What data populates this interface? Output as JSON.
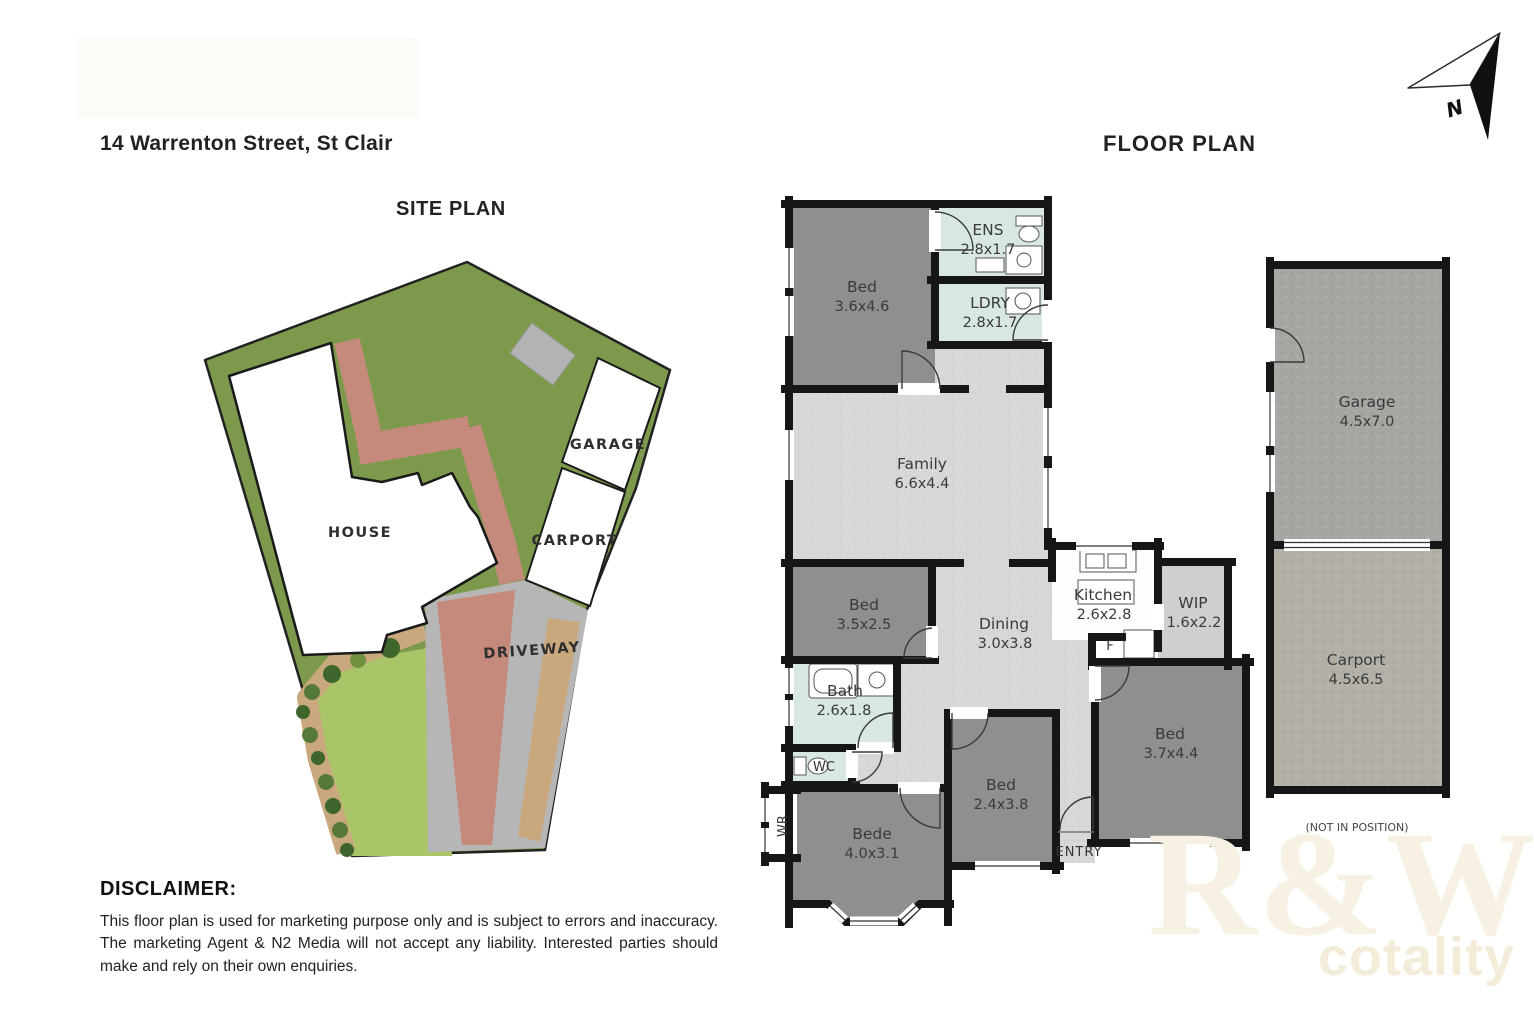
{
  "header": {
    "address": "14 Warrenton Street, St Clair",
    "site_plan_title": "SITE PLAN",
    "floor_plan_title": "FLOOR PLAN",
    "north_label": "N"
  },
  "site_plan": {
    "house_label": "HOUSE",
    "garage_label": "GARAGE",
    "carport_label": "CARPORT",
    "driveway_label": "DRIVEWAY"
  },
  "floor_plan": {
    "rooms": {
      "bed1": {
        "name": "Bed",
        "dims": "3.6x4.6"
      },
      "ens": {
        "name": "ENS",
        "dims": "2.8x1.7"
      },
      "ldry": {
        "name": "LDRY",
        "dims": "2.8x1.7"
      },
      "family": {
        "name": "Family",
        "dims": "6.6x4.4"
      },
      "bed2": {
        "name": "Bed",
        "dims": "3.5x2.5"
      },
      "kitchen": {
        "name": "Kitchen",
        "dims": "2.6x2.8"
      },
      "wip": {
        "name": "WIP",
        "dims": "1.6x2.2"
      },
      "dining": {
        "name": "Dining",
        "dims": "3.0x3.8"
      },
      "bath": {
        "name": "Bath",
        "dims": "2.6x1.8"
      },
      "wc": {
        "name": "WC"
      },
      "bede": {
        "name": "Bede",
        "dims": "4.0x3.1"
      },
      "bed3": {
        "name": "Bed",
        "dims": "2.4x3.8"
      },
      "bed4": {
        "name": "Bed",
        "dims": "3.7x4.4"
      },
      "garage": {
        "name": "Garage",
        "dims": "4.5x7.0"
      },
      "carport": {
        "name": "Carport",
        "dims": "4.5x6.5"
      }
    },
    "labels": {
      "fridge": "F",
      "wardrobe": "WR",
      "entry": "ENTRY",
      "not_in_position": "(NOT IN POSITION)"
    }
  },
  "disclaimer": {
    "title": "DISCLAIMER:",
    "body": "This floor plan is used for marketing purpose only and is subject to errors and inaccuracy. The marketing Agent & N2 Media will not accept any liability. Interested parties should make and rely on their own enquiries."
  },
  "watermark": {
    "brand": "R&W",
    "sub": "cotality"
  },
  "colors": {
    "wall": "#161616",
    "room_dark": "#8F8F8F",
    "floor_light": "#D8D8D8",
    "wet_area": "#D9E7E2",
    "kitchen_floor": "#FDFDFD",
    "wip_floor": "#CFCFCF",
    "grass": "#7D9A4C",
    "lawn": "#AAC468",
    "path_salmon": "#C68A7C",
    "driveway": "#B6B6B6",
    "garden_bed": "#C9A87E",
    "shed": "#B3B3B3"
  }
}
